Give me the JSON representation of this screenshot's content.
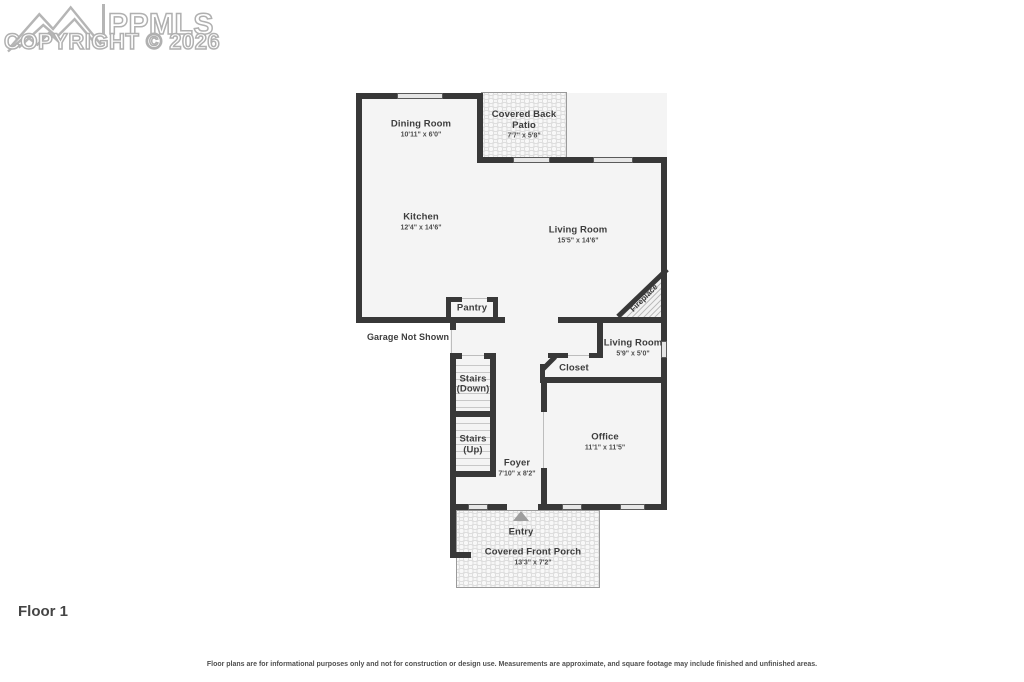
{
  "watermark": {
    "brand": "PPMLS",
    "copyright_line": "COPYRIGHT © 2026",
    "logo": "mountain-range-logo"
  },
  "floor": {
    "label": "Floor 1"
  },
  "disclaimer": "Floor plans are for informational purposes only and not for construction or design use. Measurements are approximate, and square footage may include finished and unfinished areas.",
  "rooms": {
    "dining": {
      "name": "Dining Room",
      "dims": "10'11\" x 6'0\""
    },
    "patio": {
      "name": "Covered Back Patio",
      "dims": "7'7\" x 5'8\""
    },
    "kitchen": {
      "name": "Kitchen",
      "dims": "12'4\" x 14'6\""
    },
    "living": {
      "name": "Living Room",
      "dims": "15'5\" x 14'6\""
    },
    "pantry": {
      "name": "Pantry"
    },
    "garage_note": {
      "name": "Garage Not Shown"
    },
    "stairs_down": {
      "name": "Stairs",
      "dims": "(Down)"
    },
    "stairs_up": {
      "name": "Stairs",
      "dims": "(Up)"
    },
    "closet": {
      "name": "Closet"
    },
    "living_small": {
      "name": "Living Room",
      "dims": "5'9\" x 5'0\""
    },
    "office": {
      "name": "Office",
      "dims": "11'1\" x 11'5\""
    },
    "foyer": {
      "name": "Foyer",
      "dims": "7'10\" x 8'2\""
    },
    "entry": {
      "name": "Entry"
    },
    "front_porch": {
      "name": "Covered Front Porch",
      "dims": "13'3\" x 7'2\""
    },
    "fireplace": {
      "name": "Fireplace"
    }
  },
  "colors": {
    "wall": "#383838",
    "floor_fill": "#f4f4f4",
    "label_text": "#3d3d3d",
    "watermark_gray": "#b0b0b0",
    "outdoor_border": "#9a9a9a"
  }
}
